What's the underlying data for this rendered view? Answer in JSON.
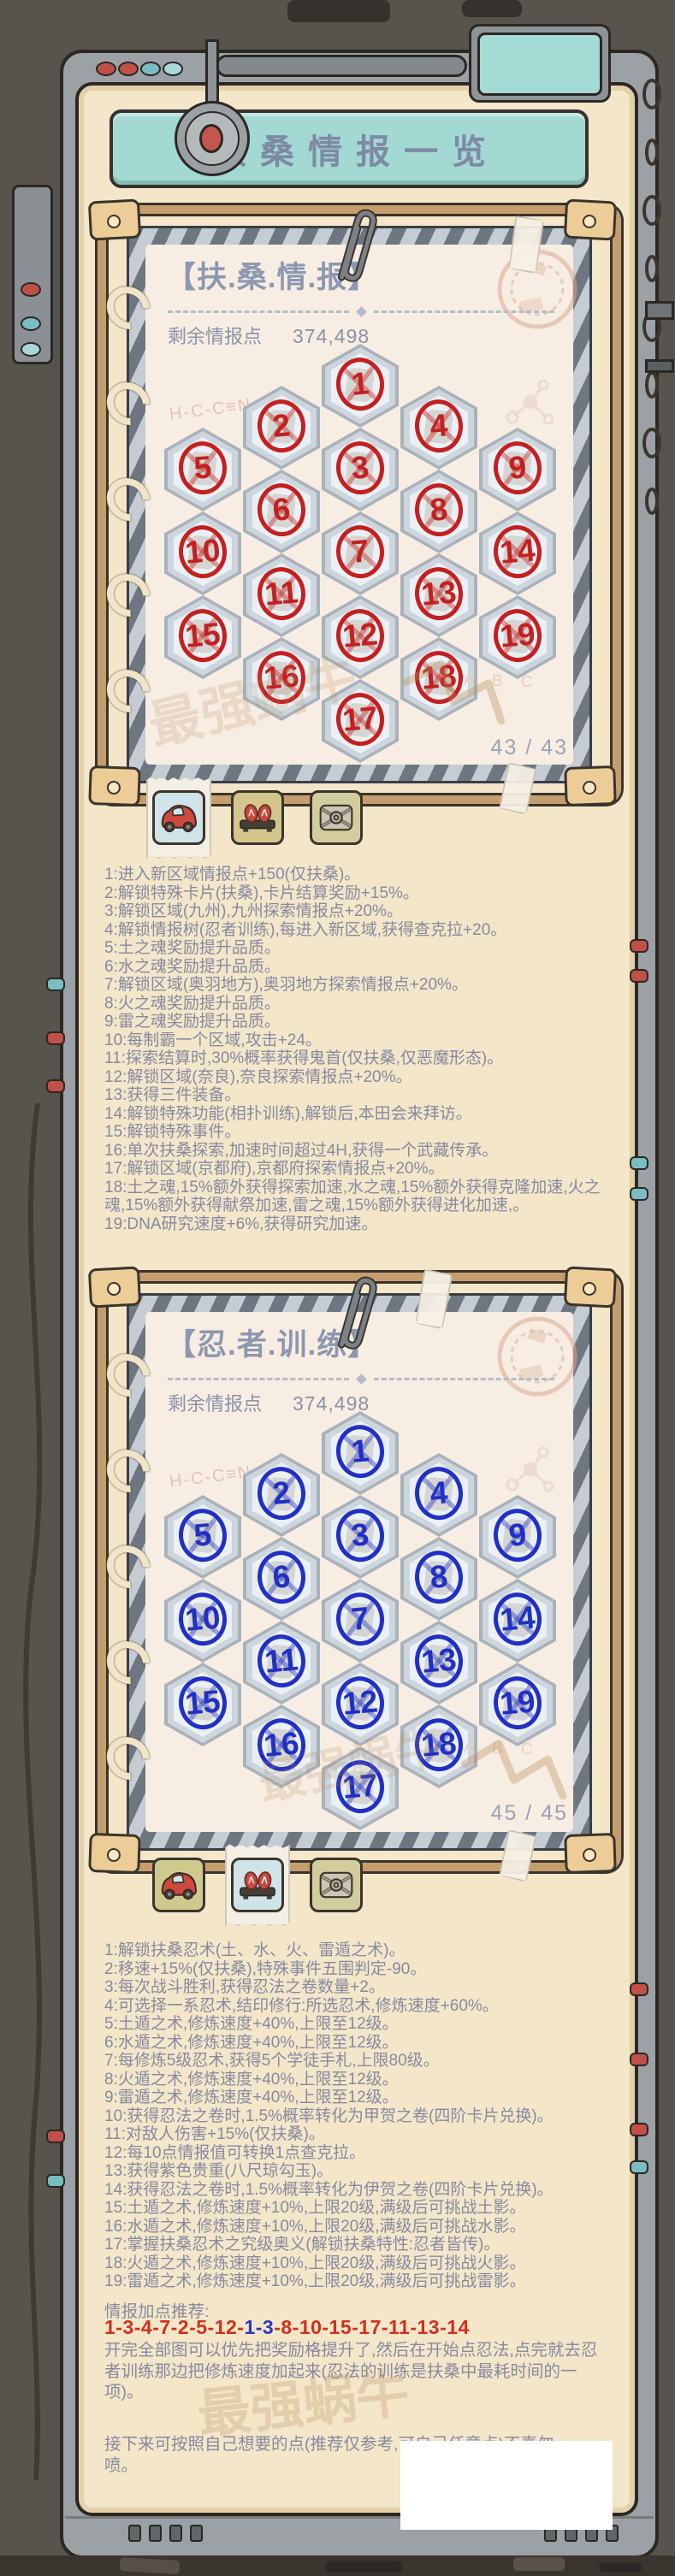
{
  "app": {
    "title": "扶桑情报一览",
    "watermark": "最强蜗牛"
  },
  "panels": [
    {
      "header": "【扶.桑.情.报】",
      "points_label": "剩余情报点",
      "points_value": "374,498",
      "counter": "43 / 43",
      "page_letters": "A B C",
      "doodle_text": "H-C-C≡N",
      "number_color": "#c32020",
      "cross_color": "rgba(195,32,32,0.40)",
      "tabs": [
        {
          "name": "car",
          "selected": true,
          "bg": "#cfe3e9"
        },
        {
          "name": "sandals",
          "selected": false,
          "bg": "#d3c68c"
        },
        {
          "name": "chest",
          "selected": false,
          "bg": "#d3cc9e"
        }
      ],
      "cells": [
        {
          "n": 1,
          "col": 2,
          "row": 0
        },
        {
          "n": 2,
          "col": 1,
          "row": 0
        },
        {
          "n": 4,
          "col": 3,
          "row": 0
        },
        {
          "n": 5,
          "col": 0,
          "row": 0
        },
        {
          "n": 3,
          "col": 2,
          "row": 1
        },
        {
          "n": 9,
          "col": 4,
          "row": 0
        },
        {
          "n": 6,
          "col": 1,
          "row": 1
        },
        {
          "n": 8,
          "col": 3,
          "row": 1
        },
        {
          "n": 10,
          "col": 0,
          "row": 1
        },
        {
          "n": 7,
          "col": 2,
          "row": 2
        },
        {
          "n": 14,
          "col": 4,
          "row": 1
        },
        {
          "n": 11,
          "col": 1,
          "row": 2
        },
        {
          "n": 13,
          "col": 3,
          "row": 2
        },
        {
          "n": 15,
          "col": 0,
          "row": 2
        },
        {
          "n": 12,
          "col": 2,
          "row": 3
        },
        {
          "n": 19,
          "col": 4,
          "row": 2
        },
        {
          "n": 16,
          "col": 1,
          "row": 3
        },
        {
          "n": 18,
          "col": 3,
          "row": 3
        },
        {
          "n": 17,
          "col": 2,
          "row": 4
        }
      ],
      "notes": [
        "1:进入新区域情报点+150(仅扶桑)。",
        "2:解锁特殊卡片(扶桑),卡片结算奖励+15%。",
        "3:解锁区域(九州),九州探索情报点+20%。",
        "4:解锁情报树(忍者训练),每进入新区域,获得查克拉+20。",
        "5:土之魂奖励提升品质。",
        "6:水之魂奖励提升品质。",
        "7:解锁区域(奥羽地方),奥羽地方探索情报点+20%。",
        "8:火之魂奖励提升品质。",
        "9:雷之魂奖励提升品质。",
        "10:每制霸一个区域,攻击+24。",
        "11:探索结算时,30%概率获得鬼首(仅扶桑,仅恶魔形态)。",
        "12:解锁区域(奈良),奈良探索情报点+20%。",
        "13:获得三件装备。",
        "14:解锁特殊功能(相扑训练),解锁后,本田会来拜访。",
        "15:解锁特殊事件。",
        "16:单次扶桑探索,加速时间超过4H,获得一个武藏传承。",
        "17:解锁区域(京都府),京都府探索情报点+20%。",
        "18:土之魂,15%额外获得探索加速,水之魂,15%额外获得克隆加速,火之魂,15%额外获得献祭加速,雷之魂,15%额外获得进化加速,。",
        "19:DNA研究速度+6%,获得研究加速。"
      ]
    },
    {
      "header": "【忍.者.训.练】",
      "points_label": "剩余情报点",
      "points_value": "374,498",
      "counter": "45 / 45",
      "page_letters": "A B C",
      "doodle_text": "H-C-C≡N",
      "number_color": "#2130c4",
      "cross_color": "rgba(33,48,196,0.40)",
      "tabs": [
        {
          "name": "car",
          "selected": false,
          "bg": "#d0c98e"
        },
        {
          "name": "sandals",
          "selected": true,
          "bg": "#cfe3e9"
        },
        {
          "name": "chest",
          "selected": false,
          "bg": "#d3cc9e"
        }
      ],
      "cells": [
        {
          "n": 1,
          "col": 2,
          "row": 0
        },
        {
          "n": 2,
          "col": 1,
          "row": 0
        },
        {
          "n": 4,
          "col": 3,
          "row": 0
        },
        {
          "n": 5,
          "col": 0,
          "row": 0
        },
        {
          "n": 3,
          "col": 2,
          "row": 1
        },
        {
          "n": 9,
          "col": 4,
          "row": 0
        },
        {
          "n": 6,
          "col": 1,
          "row": 1
        },
        {
          "n": 8,
          "col": 3,
          "row": 1
        },
        {
          "n": 10,
          "col": 0,
          "row": 1
        },
        {
          "n": 7,
          "col": 2,
          "row": 2
        },
        {
          "n": 14,
          "col": 4,
          "row": 1
        },
        {
          "n": 11,
          "col": 1,
          "row": 2
        },
        {
          "n": 13,
          "col": 3,
          "row": 2
        },
        {
          "n": 15,
          "col": 0,
          "row": 2
        },
        {
          "n": 12,
          "col": 2,
          "row": 3
        },
        {
          "n": 19,
          "col": 4,
          "row": 2
        },
        {
          "n": 16,
          "col": 1,
          "row": 3
        },
        {
          "n": 18,
          "col": 3,
          "row": 3
        },
        {
          "n": 17,
          "col": 2,
          "row": 4
        }
      ],
      "notes": [
        "1:解锁扶桑忍术(土、水、火、雷遁之术)。",
        "2:移速+15%(仅扶桑),特殊事件五围判定-90。",
        "3:每次战斗胜利,获得忍法之卷数量+2。",
        "4:可选择一系忍术,结印修行:所选忍术,修炼速度+60%。",
        "5:土遁之术,修炼速度+40%,上限至12级。",
        "6:水遁之术,修炼速度+40%,上限至12级。",
        "7:每修炼5级忍术,获得5个学徒手札,上限80级。",
        "8:火遁之术,修炼速度+40%,上限至12级。",
        "9:雷遁之术,修炼速度+40%,上限至12级。",
        "10:获得忍法之卷时,1.5%概率转化为甲贺之卷(四阶卡片兑换)。",
        "11:对敌人伤害+15%(仅扶桑)。",
        "12:每10点情报值可转换1点查克拉。",
        "13:获得紫色贵重(八尺琼勾玉)。",
        "14:获得忍法之卷时,1.5%概率转化为伊贺之卷(四阶卡片兑换)。",
        "15:土遁之术,修炼速度+10%,上限20级,满级后可挑战土影。",
        "16:水遁之术,修炼速度+10%,上限20级,满级后可挑战水影。",
        "17:掌握扶桑忍术之究级奥义(解锁扶桑特性:忍者皆传)。",
        "18:火遁之术,修炼速度+10%,上限20级,满级后可挑战火影。",
        "19:雷遁之术,修炼速度+10%,上限20级,满级后可挑战雷影。"
      ]
    }
  ],
  "footer": {
    "reco_title": "情报加点推荐:",
    "sequence": [
      {
        "text": "1-3-4-7-2-5-12-",
        "color": "#d0301e"
      },
      {
        "text": "1-3",
        "color": "#2b35c8"
      },
      {
        "text": "-8-10-15-17-11-13-14",
        "color": "#d0301e"
      }
    ],
    "para1": "开完全部图可以优先把奖励格提升了,然后在开始点忍法,点完就去忍者训练那边把修炼速度加起来(忍法的训练是扶桑中最耗时间的一项)。",
    "para2": "接下来可按照自己想要的点(推荐仅参考,可自己任意点)不喜勿喷。"
  }
}
